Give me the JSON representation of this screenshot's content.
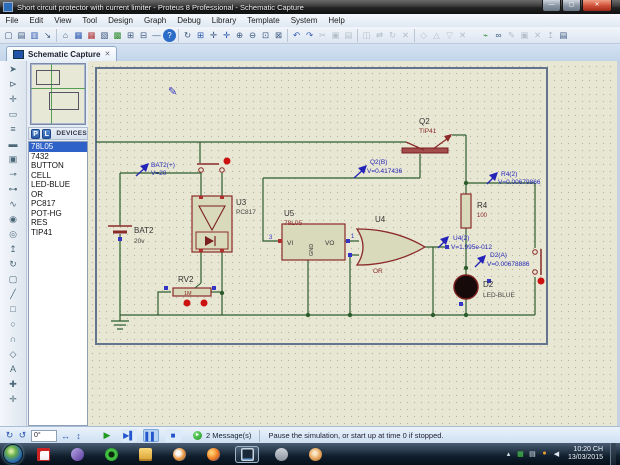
{
  "window": {
    "title": "Short circuit protector with current limiter - Proteus 8 Professional - Schematic Capture",
    "controls": [
      {
        "name": "minimize-button",
        "glyph": "—",
        "cls": "wc"
      },
      {
        "name": "maximize-button",
        "glyph": "▢",
        "cls": "wc"
      },
      {
        "name": "close-button",
        "glyph": "✕",
        "cls": "wc close"
      }
    ]
  },
  "menu": {
    "items": [
      {
        "name": "menu-file",
        "label": "File"
      },
      {
        "name": "menu-edit",
        "label": "Edit"
      },
      {
        "name": "menu-view",
        "label": "View"
      },
      {
        "name": "menu-tool",
        "label": "Tool"
      },
      {
        "name": "menu-design",
        "label": "Design"
      },
      {
        "name": "menu-graph",
        "label": "Graph"
      },
      {
        "name": "menu-debug",
        "label": "Debug"
      },
      {
        "name": "menu-library",
        "label": "Library"
      },
      {
        "name": "menu-template",
        "label": "Template"
      },
      {
        "name": "menu-system",
        "label": "System"
      },
      {
        "name": "menu-help",
        "label": "Help"
      }
    ]
  },
  "toolbar": {
    "items": [
      {
        "name": "new-project-icon",
        "glyph": "▢",
        "cls": "ti"
      },
      {
        "name": "open-project-icon",
        "glyph": "▤",
        "cls": "ti"
      },
      {
        "name": "save-project-icon",
        "glyph": "▥",
        "cls": "ti blu"
      },
      {
        "name": "import-project-icon",
        "glyph": "↘",
        "cls": "ti"
      },
      {
        "name": "toolbar-separator",
        "glyph": "",
        "cls": "sep",
        "inter": "false"
      },
      {
        "name": "home-icon",
        "glyph": "⌂",
        "cls": "ti"
      },
      {
        "name": "schematic-capture-icon",
        "glyph": "▦",
        "cls": "ti blu"
      },
      {
        "name": "pcb-layout-icon",
        "glyph": "▦",
        "cls": "ti red"
      },
      {
        "name": "3d-visualizer-icon",
        "glyph": "▧",
        "cls": "ti"
      },
      {
        "name": "design-explorer-icon",
        "glyph": "▩",
        "cls": "ti grn"
      },
      {
        "name": "new-sheet-icon",
        "glyph": "⊞",
        "cls": "ti"
      },
      {
        "name": "remove-sheet-icon",
        "glyph": "⊟",
        "cls": "ti"
      },
      {
        "name": "exit-application-icon",
        "glyph": "—",
        "cls": "ti"
      },
      {
        "name": "help-icon",
        "glyph": "?",
        "cls": "ti help"
      },
      {
        "name": "toolbar-separator",
        "glyph": "",
        "cls": "sep",
        "inter": "false"
      },
      {
        "name": "redraw-icon",
        "glyph": "↻",
        "cls": "ti"
      },
      {
        "name": "grid-toggle-icon",
        "glyph": "⊞",
        "cls": "ti blu"
      },
      {
        "name": "false-origin-icon",
        "glyph": "✛",
        "cls": "ti"
      },
      {
        "name": "pan-icon",
        "glyph": "✛",
        "cls": "ti blu"
      },
      {
        "name": "zoom-in-icon",
        "glyph": "⊕",
        "cls": "ti"
      },
      {
        "name": "zoom-out-icon",
        "glyph": "⊖",
        "cls": "ti"
      },
      {
        "name": "zoom-area-icon",
        "glyph": "⊡",
        "cls": "ti"
      },
      {
        "name": "zoom-all-icon",
        "glyph": "⊠",
        "cls": "ti"
      },
      {
        "name": "toolbar-separator",
        "glyph": "",
        "cls": "sep",
        "inter": "false"
      },
      {
        "name": "undo-icon",
        "glyph": "↶",
        "cls": "ti blu"
      },
      {
        "name": "redo-icon",
        "glyph": "↷",
        "cls": "ti blu"
      },
      {
        "name": "cut-icon",
        "glyph": "✂",
        "cls": "ti off"
      },
      {
        "name": "copy-icon",
        "glyph": "▣",
        "cls": "ti off"
      },
      {
        "name": "paste-icon",
        "glyph": "▤",
        "cls": "ti off"
      },
      {
        "name": "toolbar-separator",
        "glyph": "",
        "cls": "sep",
        "inter": "false"
      },
      {
        "name": "block-copy-icon",
        "glyph": "◫",
        "cls": "ti off"
      },
      {
        "name": "block-move-icon",
        "glyph": "⇄",
        "cls": "ti off"
      },
      {
        "name": "block-rotate-icon",
        "glyph": "↻",
        "cls": "ti off"
      },
      {
        "name": "block-delete-icon",
        "glyph": "✕",
        "cls": "ti off"
      },
      {
        "name": "toolbar-separator",
        "glyph": "",
        "cls": "sep",
        "inter": "false"
      },
      {
        "name": "pick-parts-icon",
        "glyph": "◇",
        "cls": "ti off"
      },
      {
        "name": "make-device-icon",
        "glyph": "△",
        "cls": "ti off"
      },
      {
        "name": "packaging-tool-icon",
        "glyph": "▽",
        "cls": "ti off"
      },
      {
        "name": "decompose-icon",
        "glyph": "✕",
        "cls": "ti off"
      },
      {
        "name": "toolbar-gap",
        "glyph": "",
        "cls": "gap",
        "inter": "false"
      },
      {
        "name": "wire-autorouter-icon",
        "glyph": "⌁",
        "cls": "ti grn"
      },
      {
        "name": "search-tag-icon",
        "glyph": "∞",
        "cls": "ti"
      },
      {
        "name": "property-assignment-icon",
        "glyph": "✎",
        "cls": "ti off"
      },
      {
        "name": "design-rule-icon",
        "glyph": "▣",
        "cls": "ti off"
      },
      {
        "name": "cross-probe-icon",
        "glyph": "✕",
        "cls": "ti off"
      },
      {
        "name": "goto-parent-sheet-icon",
        "glyph": "↥",
        "cls": "ti off"
      },
      {
        "name": "zoom-to-child-icon",
        "glyph": "▤",
        "cls": "ti"
      }
    ]
  },
  "tab": {
    "label": "Schematic Capture",
    "close_glyph": "✕"
  },
  "left_toolbar": {
    "tools": [
      {
        "name": "selection-mode-icon",
        "glyph": "➤"
      },
      {
        "name": "component-mode-icon",
        "glyph": "⊳"
      },
      {
        "name": "junction-dot-mode-icon",
        "glyph": "✛"
      },
      {
        "name": "wire-label-mode-icon",
        "glyph": "▭"
      },
      {
        "name": "text-script-mode-icon",
        "glyph": "≡"
      },
      {
        "name": "bus-mode-icon",
        "glyph": "▬"
      },
      {
        "name": "subcircuit-mode-icon",
        "glyph": "▣"
      },
      {
        "name": "terminal-mode-icon",
        "glyph": "⊸"
      },
      {
        "name": "device-pin-mode-icon",
        "glyph": "⊶"
      },
      {
        "name": "graph-mode-icon",
        "glyph": "∿"
      },
      {
        "name": "tape-recorder-mode-icon",
        "glyph": "◉"
      },
      {
        "name": "generator-mode-icon",
        "glyph": "◎"
      },
      {
        "name": "voltage-probe-mode-icon",
        "glyph": "↥"
      },
      {
        "name": "current-probe-mode-icon",
        "glyph": "↻"
      },
      {
        "name": "instrument-mode-icon",
        "glyph": "▢"
      },
      {
        "name": "2d-line-mode-icon",
        "glyph": "╱"
      },
      {
        "name": "2d-box-mode-icon",
        "glyph": "□"
      },
      {
        "name": "2d-circle-mode-icon",
        "glyph": "○"
      },
      {
        "name": "2d-arc-mode-icon",
        "glyph": "∩"
      },
      {
        "name": "2d-path-mode-icon",
        "glyph": "◇"
      },
      {
        "name": "2d-text-mode-icon",
        "glyph": "A"
      },
      {
        "name": "2d-symbol-mode-icon",
        "glyph": "✚"
      },
      {
        "name": "2d-marker-mode-icon",
        "glyph": "✛"
      }
    ]
  },
  "panel": {
    "p_button": "P",
    "l_button": "L",
    "header": "DEVICES",
    "devices": [
      {
        "label": "78L05",
        "cls": "dev selected"
      },
      {
        "label": "7432",
        "cls": "dev"
      },
      {
        "label": "BUTTON",
        "cls": "dev"
      },
      {
        "label": "CELL",
        "cls": "dev"
      },
      {
        "label": "LED-BLUE",
        "cls": "dev"
      },
      {
        "label": "OR",
        "cls": "dev"
      },
      {
        "label": "PC817",
        "cls": "dev"
      },
      {
        "label": "POT-HG",
        "cls": "dev"
      },
      {
        "label": "RES",
        "cls": "dev"
      },
      {
        "label": "TIP41",
        "cls": "dev"
      }
    ]
  },
  "schematic": {
    "components": {
      "bat2": {
        "ref": "BAT2",
        "value": "20v"
      },
      "u3": {
        "ref": "U3",
        "value": "PC817"
      },
      "u5": {
        "ref": "U5",
        "value": "78L05",
        "pin_left": "3",
        "pin_right": "1",
        "pin_vi": "VI",
        "pin_vo": "VO",
        "pin_gnd": "GND"
      },
      "u4": {
        "ref": "U4",
        "value": "OR"
      },
      "q2": {
        "ref": "Q2",
        "value": "TIP41"
      },
      "r4": {
        "ref": "R4",
        "value": "100"
      },
      "rv2": {
        "ref": "RV2",
        "value": "1M"
      },
      "d2": {
        "ref": "D2",
        "value": "LED-BLUE"
      }
    },
    "probes": {
      "bat2_plus": {
        "label": "BAT2(+)",
        "value": "V=20"
      },
      "q2_b": {
        "label": "Q2(B)",
        "value": "V=0.417436"
      },
      "r4_2": {
        "label": "R4(2)",
        "value": "V=0.00679866"
      },
      "u4_2": {
        "label": "U4(2)",
        "value": "V=1.995e-012"
      },
      "d2_a": {
        "label": "D2(A)",
        "value": "V=0.00678886"
      }
    },
    "colors": {
      "wire": "#2d5c2d",
      "component_outline": "#8b2a2a",
      "component_fill": "#d9d9bc",
      "probe": "#2424b8",
      "canvas": "#e7e7d3"
    }
  },
  "bottom_bar": {
    "orientation": [
      {
        "name": "rotate-clockwise-button",
        "glyph": "↻"
      },
      {
        "name": "rotate-anticlockwise-button",
        "glyph": "↺"
      }
    ],
    "angle_value": "0°",
    "mirror": [
      {
        "name": "x-mirror-button",
        "glyph": "↔"
      },
      {
        "name": "y-mirror-button",
        "glyph": "↕"
      }
    ],
    "sim_buttons": [
      {
        "name": "play-button",
        "glyph": "▶",
        "cls": "sb play"
      },
      {
        "name": "step-button",
        "glyph": "▶▌",
        "cls": "sb step"
      },
      {
        "name": "pause-button",
        "glyph": "▌▌",
        "cls": "sb pause active"
      },
      {
        "name": "stop-button",
        "glyph": "■",
        "cls": "sb stop"
      }
    ],
    "message_icon_glyph": "▸",
    "messages_label": "2 Message(s)",
    "status_text": "Pause the simulation, or start up at time 0 if stopped."
  },
  "taskbar": {
    "apps": [
      {
        "name": "taskbar-app-red-grid",
        "cls": "tbapp a1"
      },
      {
        "name": "taskbar-app-kmplayer",
        "cls": "tbapp a2"
      },
      {
        "name": "taskbar-app-green-ring",
        "cls": "tbapp a3"
      },
      {
        "name": "taskbar-app-explorer",
        "cls": "tbapp a4"
      },
      {
        "name": "taskbar-app-media-player",
        "cls": "tbapp a5"
      },
      {
        "name": "taskbar-app-firefox",
        "cls": "tbapp a6"
      },
      {
        "name": "taskbar-app-proteus-active",
        "cls": "tbapp a7"
      },
      {
        "name": "taskbar-app-gray",
        "cls": "tbapp a8"
      },
      {
        "name": "taskbar-app-proteus8",
        "cls": "tbapp a9"
      }
    ],
    "tray": [
      {
        "name": "tray-show-hidden-icons",
        "glyph": "▴",
        "cls": "tri"
      },
      {
        "name": "tray-green-icon",
        "glyph": "▦",
        "cls": "tri grn"
      },
      {
        "name": "tray-input-icon",
        "glyph": "▤",
        "cls": "tri"
      },
      {
        "name": "tray-orange-icon",
        "glyph": "●",
        "cls": "tri org"
      },
      {
        "name": "tray-volume-icon",
        "glyph": "◀",
        "cls": "tri"
      }
    ],
    "clock": {
      "time": "10:20 CH",
      "date": "13/03/2015"
    }
  }
}
